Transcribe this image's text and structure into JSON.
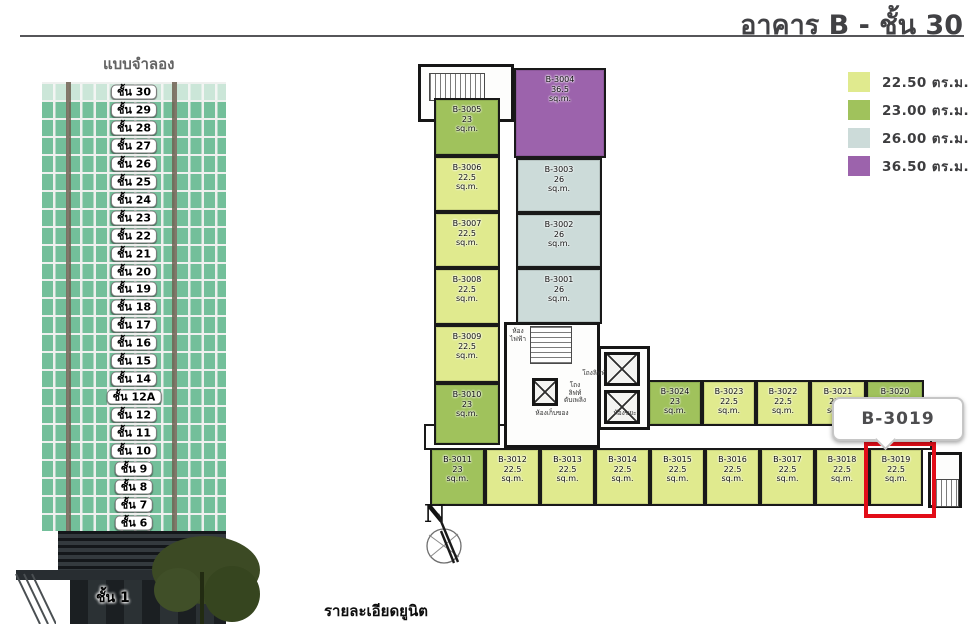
{
  "header": {
    "title": "อาคาร B - ชั้น 30"
  },
  "model": {
    "title": "แบบจำลอง",
    "floor_prefix": "ชั้น",
    "floors": [
      "30",
      "29",
      "28",
      "27",
      "26",
      "25",
      "24",
      "23",
      "22",
      "21",
      "20",
      "19",
      "18",
      "17",
      "16",
      "15",
      "14",
      "12A",
      "12",
      "11",
      "10",
      "9",
      "8",
      "7",
      "6"
    ],
    "highlighted_floor": "30",
    "ground_floor_label": "ชั้น 1"
  },
  "legend": {
    "items": [
      {
        "color": "#e0ea8e",
        "label": "22.50 ตร.ม."
      },
      {
        "color": "#a0c25c",
        "label": "23.00 ตร.ม."
      },
      {
        "color": "#ccdbd9",
        "label": "26.00 ตร.ม."
      },
      {
        "color": "#9c63ac",
        "label": "36.50 ตร.ม."
      }
    ]
  },
  "plan": {
    "area_unit": "sq.m.",
    "units": [
      {
        "id": "B-3005",
        "area": "23",
        "size": "23",
        "x": 434,
        "y": 98,
        "w": 66,
        "h": 58
      },
      {
        "id": "B-3006",
        "area": "22.5",
        "size": "22.5",
        "x": 434,
        "y": 156,
        "w": 66,
        "h": 56
      },
      {
        "id": "B-3007",
        "area": "22.5",
        "size": "22.5",
        "x": 434,
        "y": 212,
        "w": 66,
        "h": 56
      },
      {
        "id": "B-3008",
        "area": "22.5",
        "size": "22.5",
        "x": 434,
        "y": 268,
        "w": 66,
        "h": 57
      },
      {
        "id": "B-3009",
        "area": "22.5",
        "size": "22.5",
        "x": 434,
        "y": 325,
        "w": 66,
        "h": 58
      },
      {
        "id": "B-3010",
        "area": "23",
        "size": "23",
        "x": 434,
        "y": 383,
        "w": 66,
        "h": 62
      },
      {
        "id": "B-3004",
        "area": "36.5",
        "size": "36.5",
        "x": 514,
        "y": 68,
        "w": 92,
        "h": 90
      },
      {
        "id": "B-3003",
        "area": "26",
        "size": "26",
        "x": 516,
        "y": 158,
        "w": 86,
        "h": 55
      },
      {
        "id": "B-3002",
        "area": "26",
        "size": "26",
        "x": 516,
        "y": 213,
        "w": 86,
        "h": 55
      },
      {
        "id": "B-3001",
        "area": "26",
        "size": "26",
        "x": 516,
        "y": 268,
        "w": 86,
        "h": 56
      },
      {
        "id": "B-3024",
        "area": "23",
        "size": "23",
        "x": 648,
        "y": 380,
        "w": 54,
        "h": 46
      },
      {
        "id": "B-3023",
        "area": "22.5",
        "size": "22.5",
        "x": 702,
        "y": 380,
        "w": 54,
        "h": 46
      },
      {
        "id": "B-3022",
        "area": "22.5",
        "size": "22.5",
        "x": 756,
        "y": 380,
        "w": 54,
        "h": 46
      },
      {
        "id": "B-3021",
        "area": "22.5",
        "size": "22.5",
        "x": 810,
        "y": 380,
        "w": 56,
        "h": 46
      },
      {
        "id": "B-3020",
        "area": "23",
        "size": "23",
        "x": 866,
        "y": 380,
        "w": 58,
        "h": 46
      },
      {
        "id": "B-3011",
        "area": "23",
        "size": "23",
        "x": 430,
        "y": 448,
        "w": 55,
        "h": 58
      },
      {
        "id": "B-3012",
        "area": "22.5",
        "size": "22.5",
        "x": 485,
        "y": 448,
        "w": 55,
        "h": 58
      },
      {
        "id": "B-3013",
        "area": "22.5",
        "size": "22.5",
        "x": 540,
        "y": 448,
        "w": 55,
        "h": 58
      },
      {
        "id": "B-3014",
        "area": "22.5",
        "size": "22.5",
        "x": 595,
        "y": 448,
        "w": 55,
        "h": 58
      },
      {
        "id": "B-3015",
        "area": "22.5",
        "size": "22.5",
        "x": 650,
        "y": 448,
        "w": 55,
        "h": 58
      },
      {
        "id": "B-3016",
        "area": "22.5",
        "size": "22.5",
        "x": 705,
        "y": 448,
        "w": 55,
        "h": 58
      },
      {
        "id": "B-3017",
        "area": "22.5",
        "size": "22.5",
        "x": 760,
        "y": 448,
        "w": 55,
        "h": 58
      },
      {
        "id": "B-3018",
        "area": "22.5",
        "size": "22.5",
        "x": 815,
        "y": 448,
        "w": 54,
        "h": 58
      },
      {
        "id": "B-3019",
        "area": "22.5",
        "size": "22.5",
        "x": 869,
        "y": 448,
        "w": 54,
        "h": 58
      }
    ],
    "core_rooms": [
      {
        "label": "ห้อง\nไฟฟ้า",
        "x": 505,
        "y": 328,
        "w": 26
      },
      {
        "label": "โถงลิฟท์",
        "x": 576,
        "y": 370,
        "w": 36
      },
      {
        "label": "โถง\nลิฟท์\nดับเพลิง",
        "x": 562,
        "y": 382,
        "w": 26
      },
      {
        "label": "ห้องเก็บของ",
        "x": 527,
        "y": 410,
        "w": 50
      },
      {
        "label": "ห้องขยะ",
        "x": 608,
        "y": 410,
        "w": 34
      }
    ],
    "compass_label": "N",
    "selection": {
      "unit_id": "B-3019",
      "callout_label": "B-3019",
      "highlight_color": "#e20d18"
    }
  },
  "footer": {
    "caption": "รายละเอียดยูนิต"
  }
}
